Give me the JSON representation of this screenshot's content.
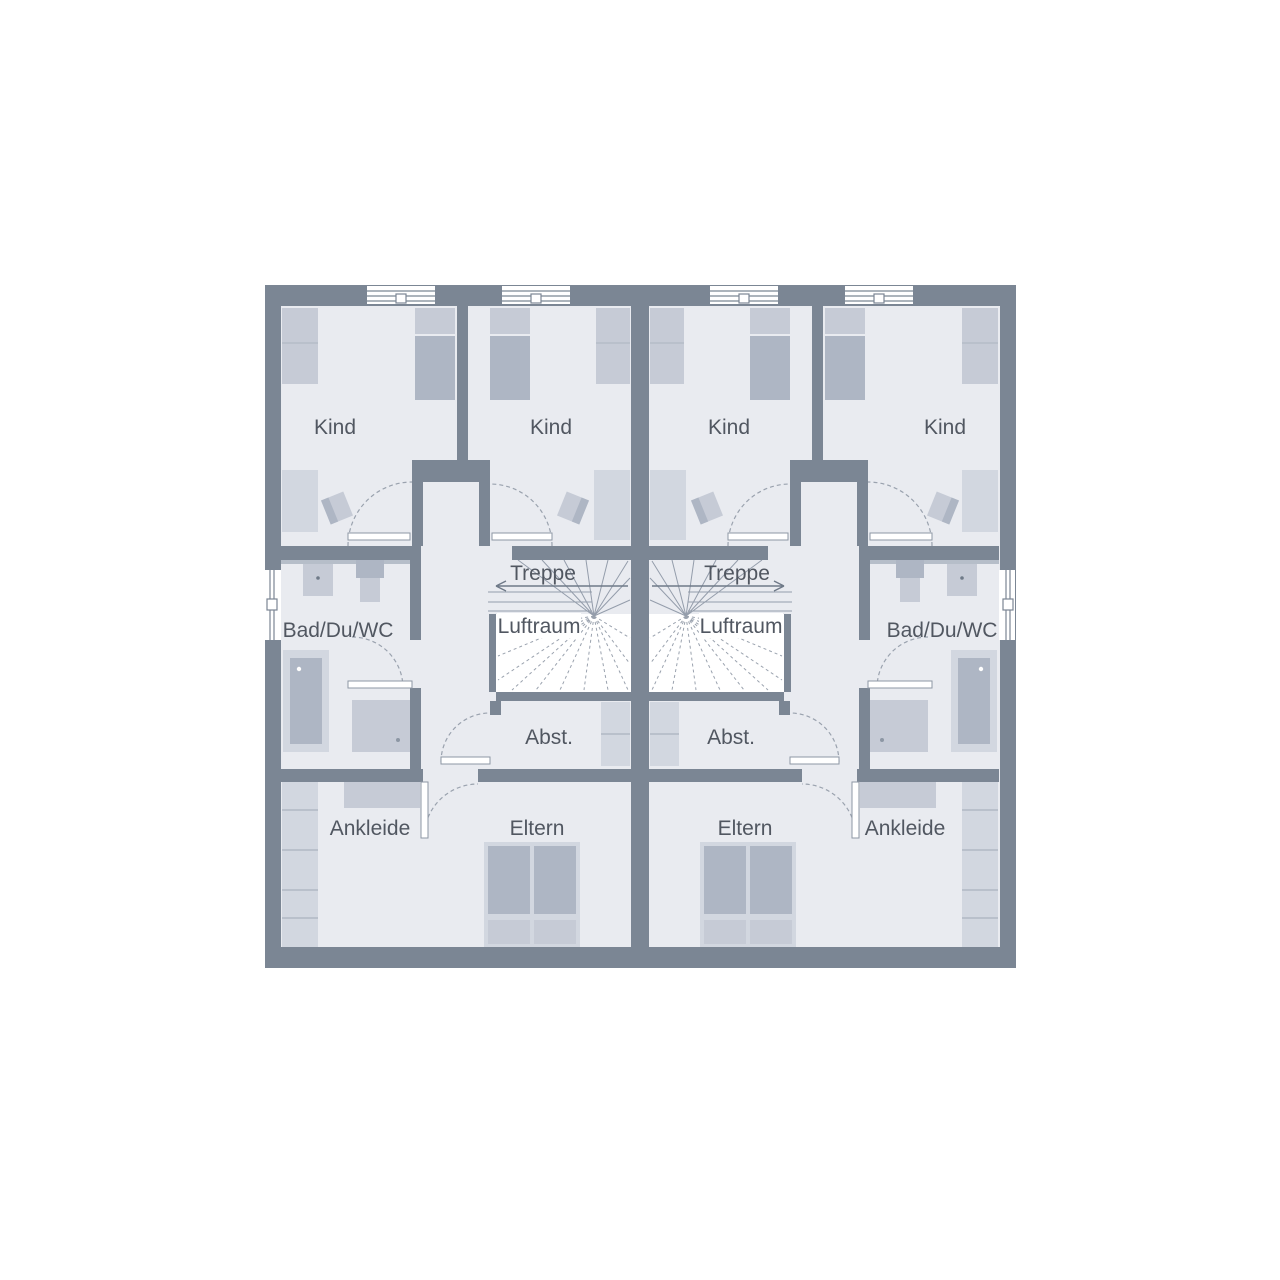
{
  "figure": {
    "type": "floor-plan",
    "description": "Upper floor plan of a mirrored duplex (two identical units)",
    "units_count": 2
  },
  "labels": {
    "kind": "Kind",
    "treppe": "Treppe",
    "luftraum": "Luftraum",
    "bad": "Bad/Du/WC",
    "abst": "Abst.",
    "ankleide": "Ankleide",
    "eltern": "Eltern"
  },
  "units": [
    {
      "side": "left",
      "rooms": [
        "Kind",
        "Kind",
        "Bad/Du/WC",
        "Treppe",
        "Luftraum",
        "Abst.",
        "Ankleide",
        "Eltern"
      ]
    },
    {
      "side": "right",
      "rooms": [
        "Kind",
        "Kind",
        "Bad/Du/WC",
        "Treppe",
        "Luftraum",
        "Abst.",
        "Ankleide",
        "Eltern"
      ]
    }
  ],
  "colors": {
    "background": "#ffffff",
    "wall": "#7b8694",
    "floor": "#e9ebf0",
    "furniture_light": "#d2d7e0",
    "furniture_medium": "#aeb6c4",
    "furniture_pale": "#c6cbd6",
    "counter_band": "#b6bec9",
    "text": "#515761",
    "stair_line": "#949dab",
    "void": "#ffffff"
  }
}
